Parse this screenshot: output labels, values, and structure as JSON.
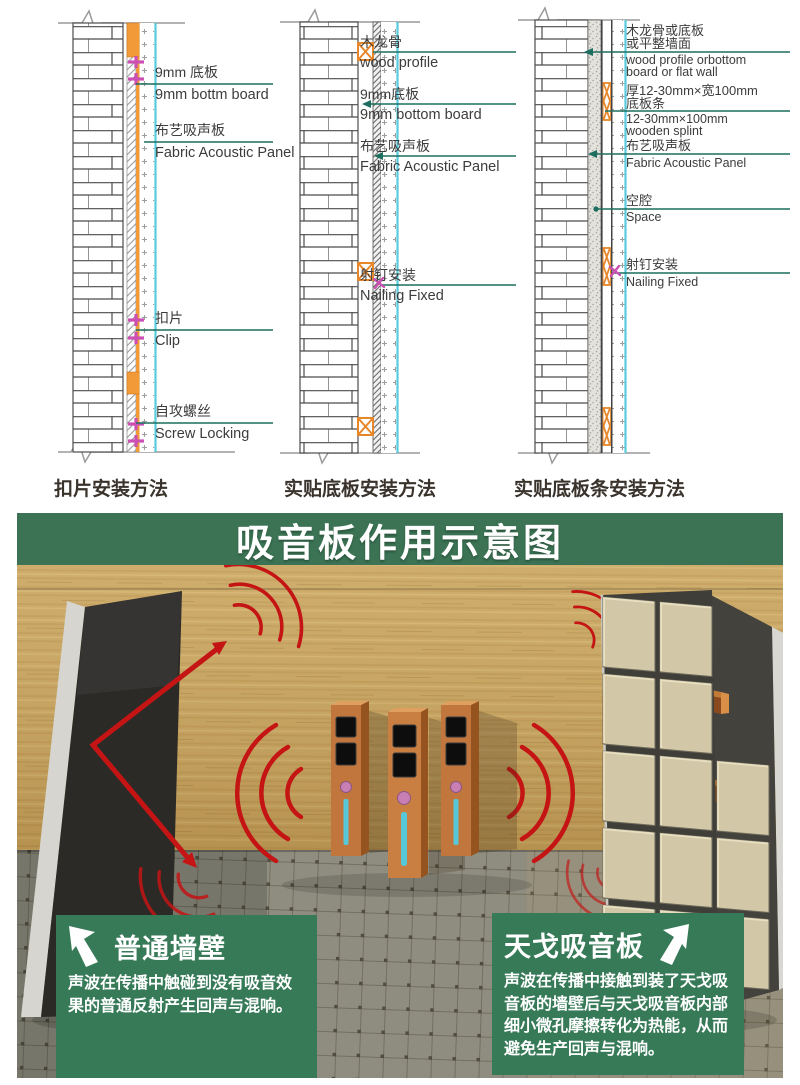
{
  "colors": {
    "banner_green": "#3b7354",
    "card_green": "#377a58",
    "wave_red": "#c41414",
    "leader_green": "#1d6e5f",
    "profile_orange": "#f29a38",
    "clip_magenta": "#cc4fb4",
    "panel_surface_cyan": "#58cbdc",
    "wood_wall": "#c9a45b",
    "floor_gray": "#8f8d80"
  },
  "diagrams": {
    "d1": {
      "caption": "扣片安装方法",
      "labels": {
        "l1": {
          "cn": "9mm 底板",
          "en": "9mm bottm board"
        },
        "l2": {
          "cn": "布艺吸声板",
          "en": "Fabric Acoustic Panel"
        },
        "l3": {
          "cn": "扣片",
          "en": "Clip"
        },
        "l4": {
          "cn": "自攻螺丝",
          "en": "Screw Locking"
        }
      }
    },
    "d2": {
      "caption": "实贴底板安装方法",
      "labels": {
        "l1": {
          "cn": "木龙骨",
          "en": "wood profile"
        },
        "l2": {
          "cn": "9mm底板",
          "en": "9mm bottom board"
        },
        "l3": {
          "cn": "布艺吸声板",
          "en": "Fabric Acoustic Panel"
        },
        "l4": {
          "cn": "射钉安装",
          "en": "Nailing Fixed"
        }
      }
    },
    "d3": {
      "caption": "实贴底板条安装方法",
      "labels": {
        "l1": {
          "cn": "木龙骨或底板",
          "cn2": "或平整墙面",
          "en": "wood profile orbottom",
          "en2": "board or flat wall"
        },
        "l2": {
          "cn": "厚12-30mm×宽100mm",
          "cn2": "底板条",
          "en": "12-30mm×100mm",
          "en2": "wooden splint"
        },
        "l3": {
          "cn": "布艺吸声板",
          "en": "Fabric Acoustic Panel"
        },
        "l4": {
          "cn": "空腔",
          "en": "Space"
        },
        "l5": {
          "cn": "射钉安装",
          "en": "Nailing Fixed"
        }
      }
    }
  },
  "poster": {
    "title": "吸音板作用示意图",
    "left_card": {
      "title": "普通墙壁",
      "body": "声波在传播中触碰到没有吸音效果的普通反射产生回声与混响。"
    },
    "right_card": {
      "title": "天戈吸音板",
      "body": "声波在传播中接触到装了天戈吸音板的墙壁后与天戈吸音板内部细小微孔摩擦转化为热能，从而避免生产回声与混响。"
    }
  }
}
